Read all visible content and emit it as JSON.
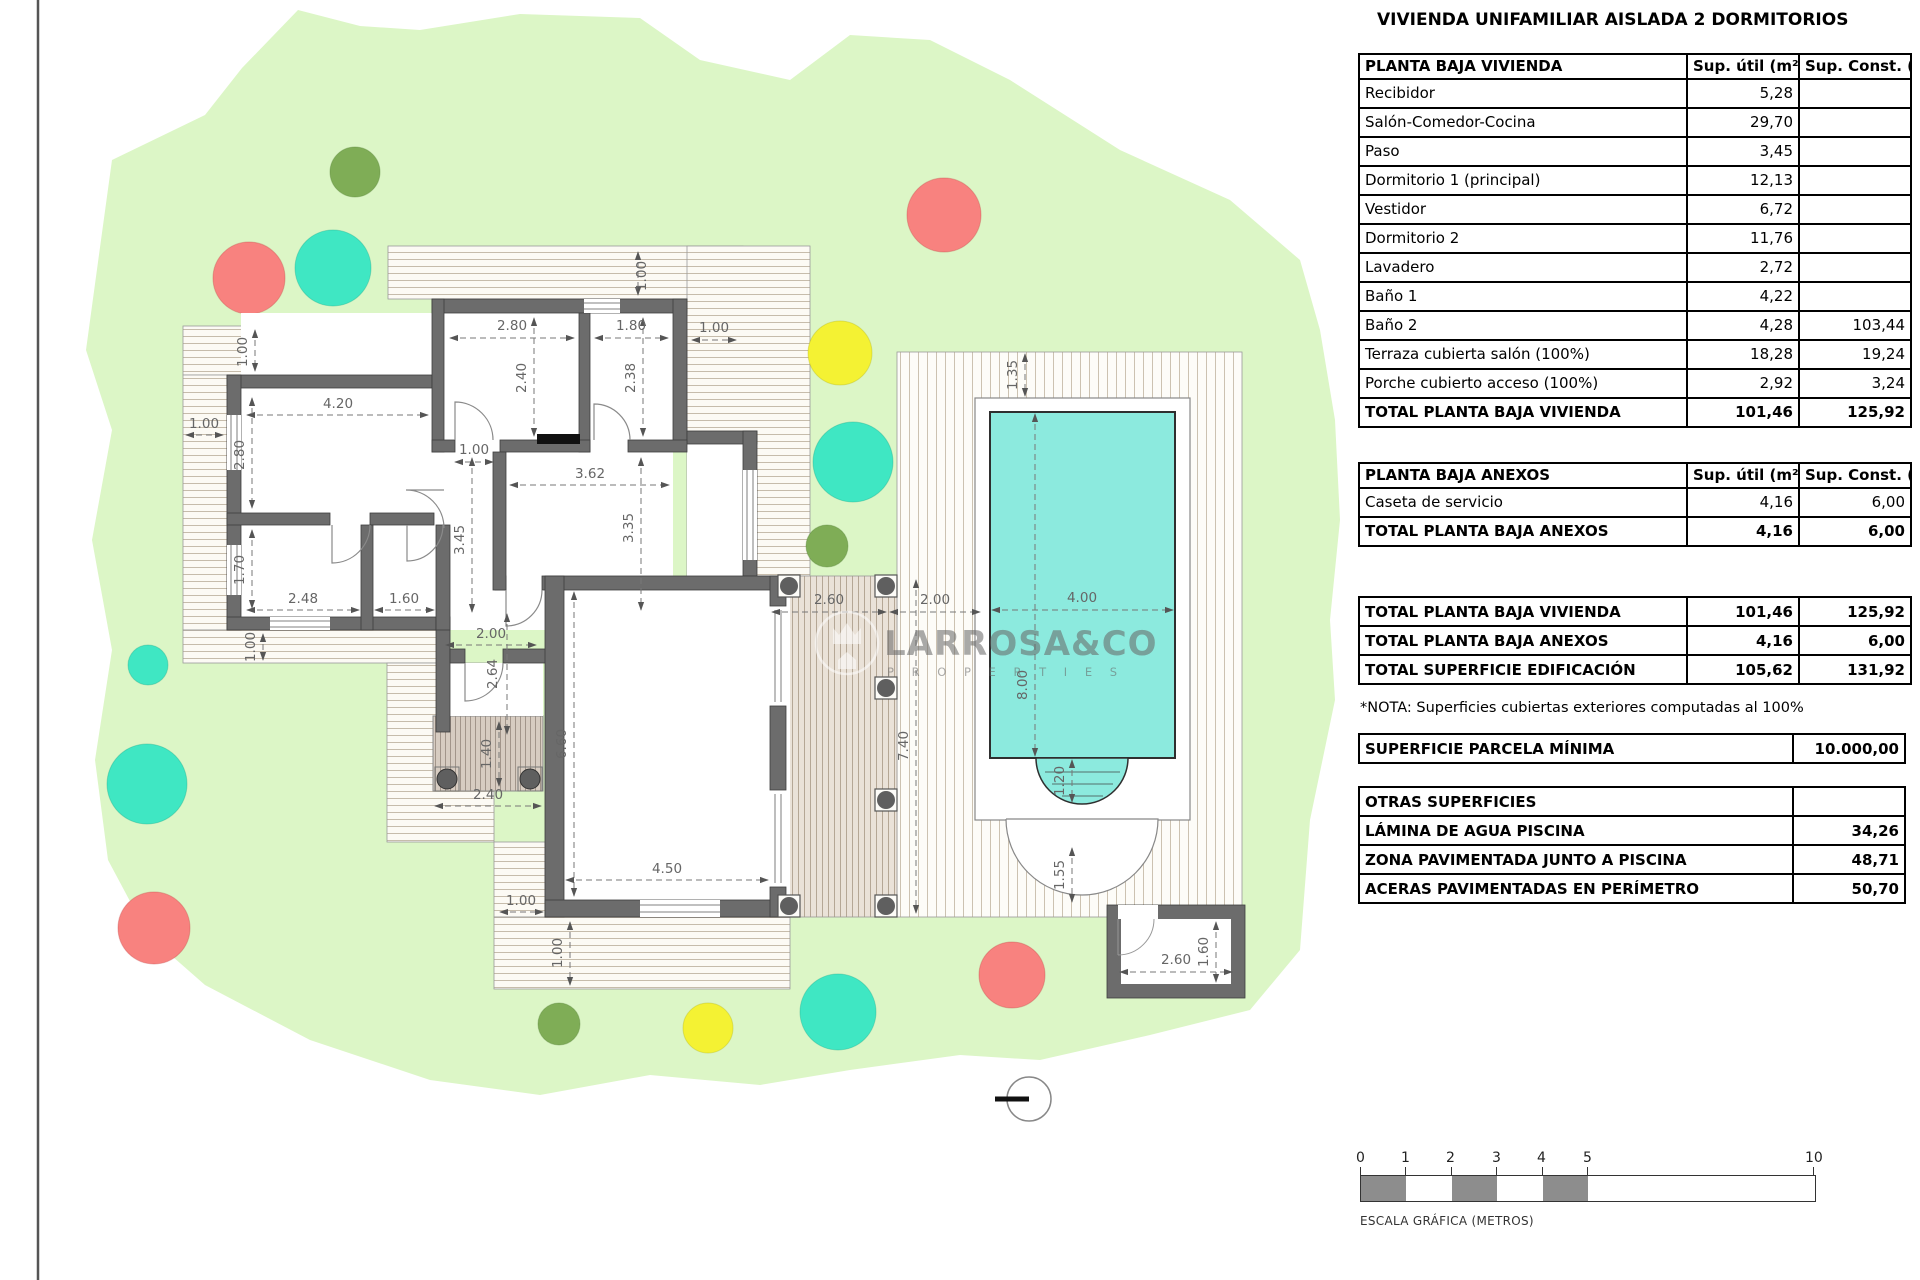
{
  "title": "VIVIENDA UNIFAMILIAR AISLADA 2 DORMITORIOS",
  "columns": {
    "util": "Sup. útil\n(m²)",
    "const": "Sup. Const.\n(m²)"
  },
  "vivienda": {
    "header": "PLANTA BAJA VIVIENDA",
    "rows": [
      {
        "label": "Recibidor",
        "util": "5,28",
        "const": ""
      },
      {
        "label": "Salón-Comedor-Cocina",
        "util": "29,70",
        "const": ""
      },
      {
        "label": "Paso",
        "util": "3,45",
        "const": ""
      },
      {
        "label": "Dormitorio 1 (principal)",
        "util": "12,13",
        "const": ""
      },
      {
        "label": "Vestidor",
        "util": "6,72",
        "const": ""
      },
      {
        "label": "Dormitorio 2",
        "util": "11,76",
        "const": ""
      },
      {
        "label": "Lavadero",
        "util": "2,72",
        "const": ""
      },
      {
        "label": "Baño 1",
        "util": "4,22",
        "const": ""
      },
      {
        "label": "Baño 2",
        "util": "4,28",
        "const": "103,44"
      },
      {
        "label": "Terraza cubierta salón (100%)",
        "util": "18,28",
        "const": "19,24"
      },
      {
        "label": "Porche cubierto acceso (100%)",
        "util": "2,92",
        "const": "3,24"
      }
    ],
    "total": {
      "label": "TOTAL PLANTA BAJA VIVIENDA",
      "util": "101,46",
      "const": "125,92"
    }
  },
  "anexos": {
    "header": "PLANTA BAJA ANEXOS",
    "rows": [
      {
        "label": "Caseta de servicio",
        "util": "4,16",
        "const": "6,00"
      }
    ],
    "total": {
      "label": "TOTAL PLANTA BAJA ANEXOS",
      "util": "4,16",
      "const": "6,00"
    }
  },
  "resumen": [
    {
      "label": "TOTAL PLANTA BAJA VIVIENDA",
      "util": "101,46",
      "const": "125,92"
    },
    {
      "label": "TOTAL PLANTA BAJA ANEXOS",
      "util": "4,16",
      "const": "6,00"
    },
    {
      "label": "TOTAL SUPERFICIE EDIFICACIÓN",
      "util": "105,62",
      "const": "131,92"
    }
  ],
  "nota": "*NOTA: Superficies cubiertas exteriores computadas al 100%",
  "parcela": {
    "label": "SUPERFICIE PARCELA MÍNIMA",
    "value": "10.000,00"
  },
  "otras": {
    "header": "OTRAS SUPERFICIES",
    "rows": [
      {
        "label": "LÁMINA DE AGUA PISCINA",
        "value": "34,26"
      },
      {
        "label": "ZONA PAVIMENTADA JUNTO A PISCINA",
        "value": "48,71"
      },
      {
        "label": "ACERAS PAVIMENTADAS EN PERÍMETRO",
        "value": "50,70"
      }
    ]
  },
  "scalebar": {
    "ticks": [
      "0",
      "1",
      "2",
      "3",
      "4",
      "5",
      "10"
    ],
    "label": "ESCALA GRÁFICA (METROS)"
  },
  "watermark": {
    "line1": "LARROSA&CO",
    "line2": "P R O P E R T I E S"
  },
  "dims": [
    "1.00",
    "2.80",
    "1.80",
    "1.00",
    "1.00",
    "2.40",
    "2.38",
    "4.20",
    "1.00",
    "2.80",
    "1.00",
    "3.62",
    "3.45",
    "3.35",
    "1.70",
    "2.48",
    "1.60",
    "2.00",
    "2.64",
    "1.00",
    "1.40",
    "2.40",
    "6.60",
    "4.50",
    "1.00",
    "1.00",
    "2.60",
    "2.00",
    "7.40",
    "1.35",
    "4.00",
    "8.00",
    "1.20",
    "1.55",
    "2.60",
    "1.60"
  ],
  "colors": {
    "garden": "#dcf6c6",
    "deckBg": "#fcfaf4",
    "deckStripe": "#c6bcab",
    "terraceBg": "#fdfcf8",
    "terraceStripe": "#ccc2b1",
    "coveredBg": "#eae2d8",
    "coveredStripe": "#b5a795",
    "pergolaBg": "#d7ccc1",
    "pergolaStripe": "#a2958a",
    "wall": "#6c6c6c",
    "wallDark": "#3e3e3e",
    "pool": "#8ceade",
    "poolBorder": "#2f2f2f",
    "treeRed": "#f8827f",
    "treeTeal": "#3fe7c3",
    "treeYellow": "#f4f233",
    "treeOlive": "#7fad56",
    "beige": "#eceada",
    "blue": "#cfe9f3",
    "dim": "#666666",
    "scaleGray": "#8d8d8d"
  }
}
